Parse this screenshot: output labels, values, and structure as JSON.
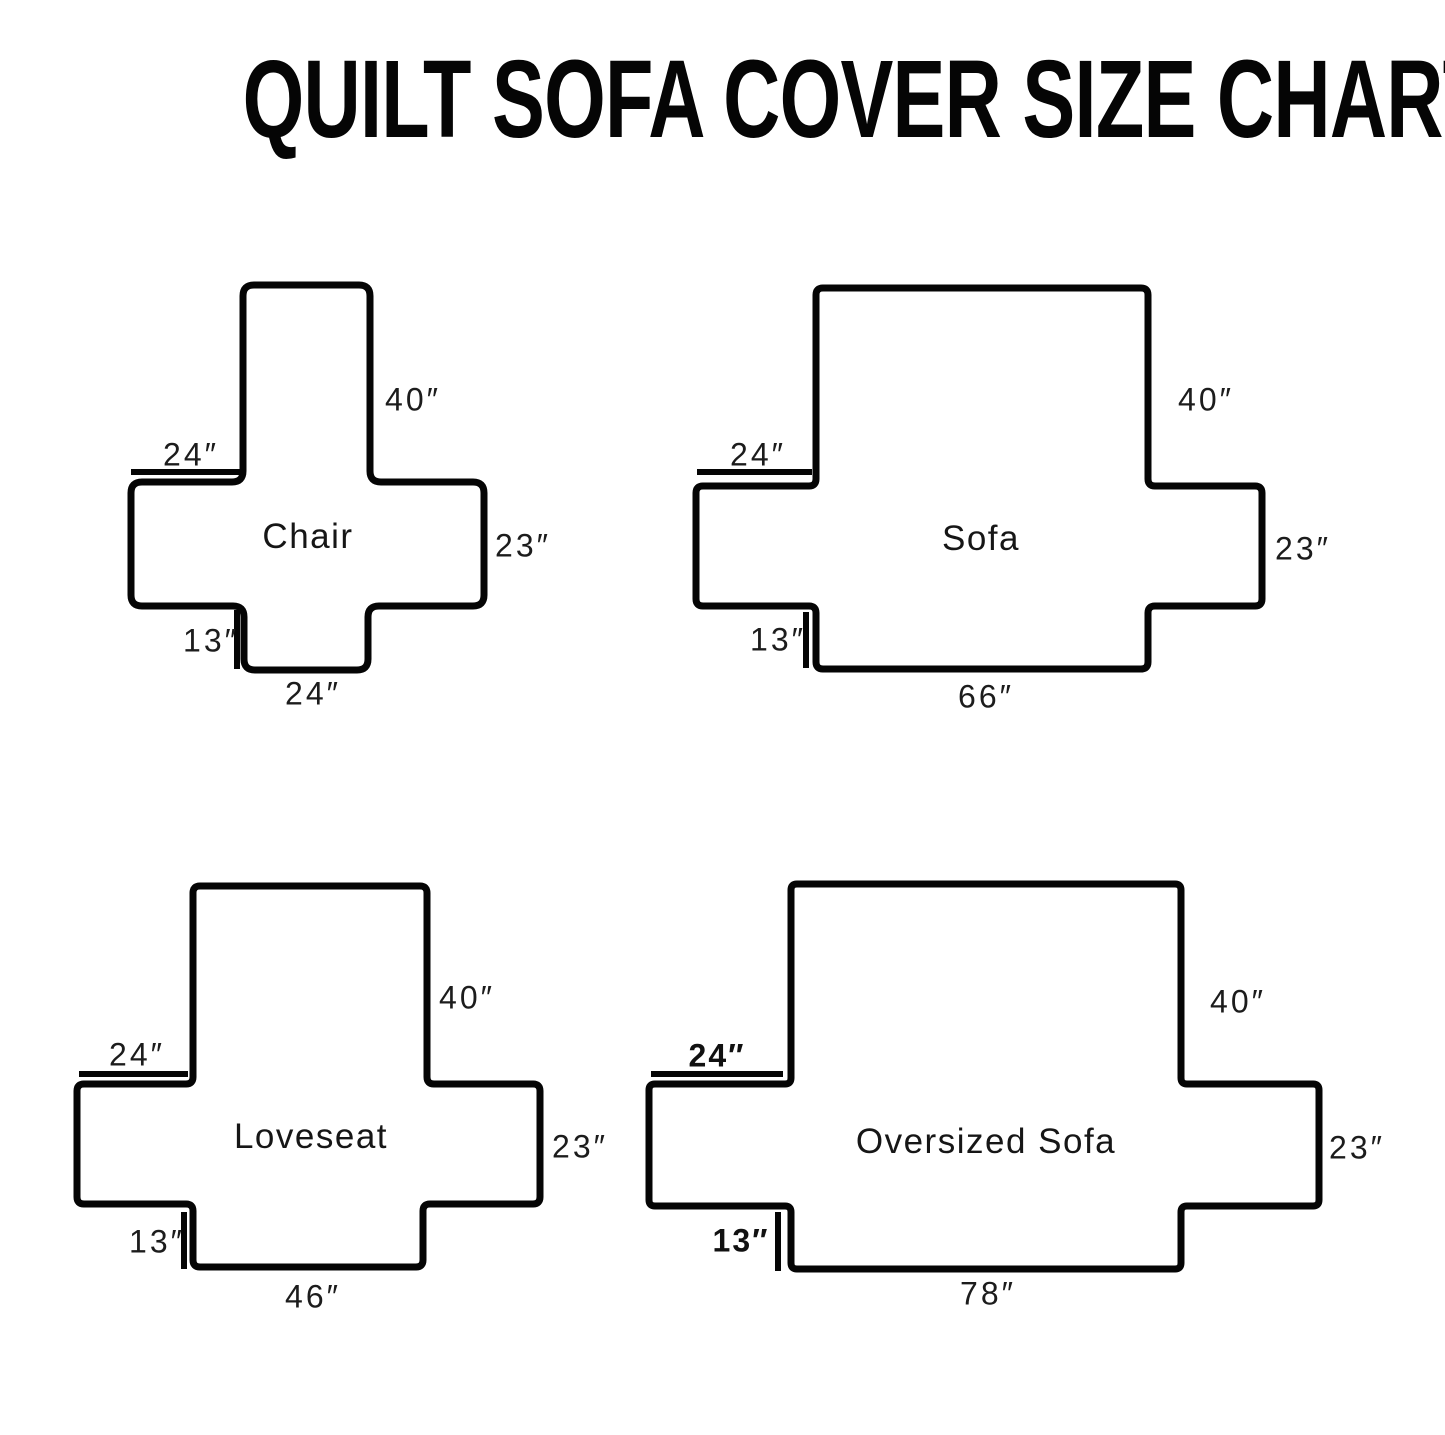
{
  "title": "QUILT SOFA COVER SIZE CHART",
  "diagrams": [
    {
      "name": "Chair",
      "back_height": "40″",
      "arm_width": "24″",
      "arm_height": "23″",
      "skirt_drop": "13″",
      "bottom_width": "24″"
    },
    {
      "name": "Sofa",
      "back_height": "40″",
      "arm_width": "24″",
      "arm_height": "23″",
      "skirt_drop": "13″",
      "bottom_width": "66″"
    },
    {
      "name": "Loveseat",
      "back_height": "40″",
      "arm_width": "24″",
      "arm_height": "23″",
      "skirt_drop": "13″",
      "bottom_width": "46″"
    },
    {
      "name": "Oversized Sofa",
      "back_height": "40″",
      "arm_width": "24″",
      "arm_height": "23″",
      "skirt_drop": "13″",
      "bottom_width": "78″"
    }
  ]
}
